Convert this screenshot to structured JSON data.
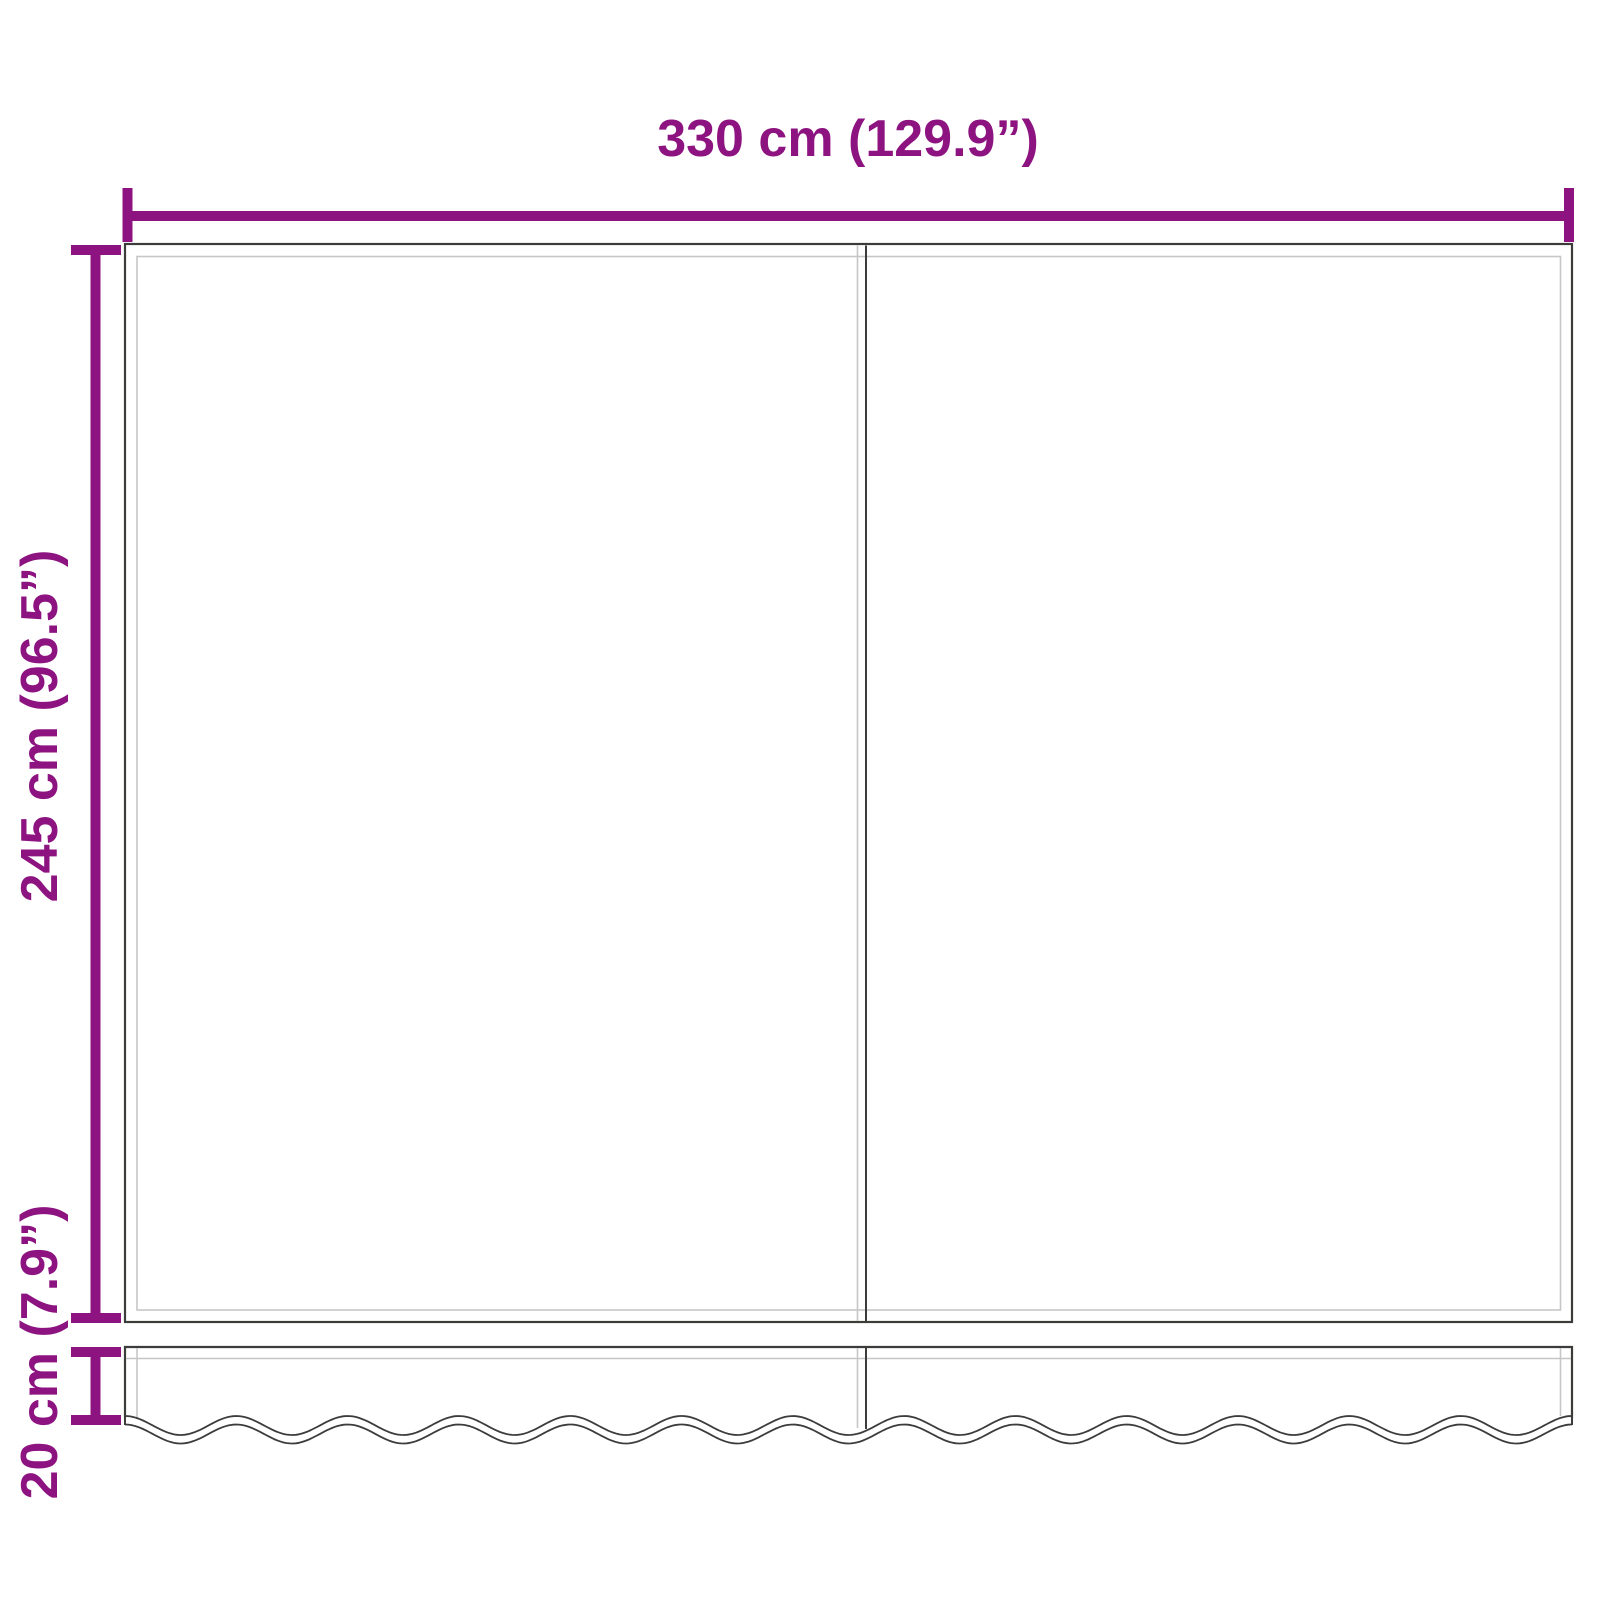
{
  "diagram": {
    "colors": {
      "accent": "#8C1380",
      "line_dark": "#3C3C3B",
      "line_light": "#C6C6C6",
      "background": "#FFFFFF"
    },
    "labels": {
      "width": "330 cm (129.9”)",
      "height": "245 cm (96.5”)",
      "valance_height": "20 cm (7.9”)"
    }
  }
}
